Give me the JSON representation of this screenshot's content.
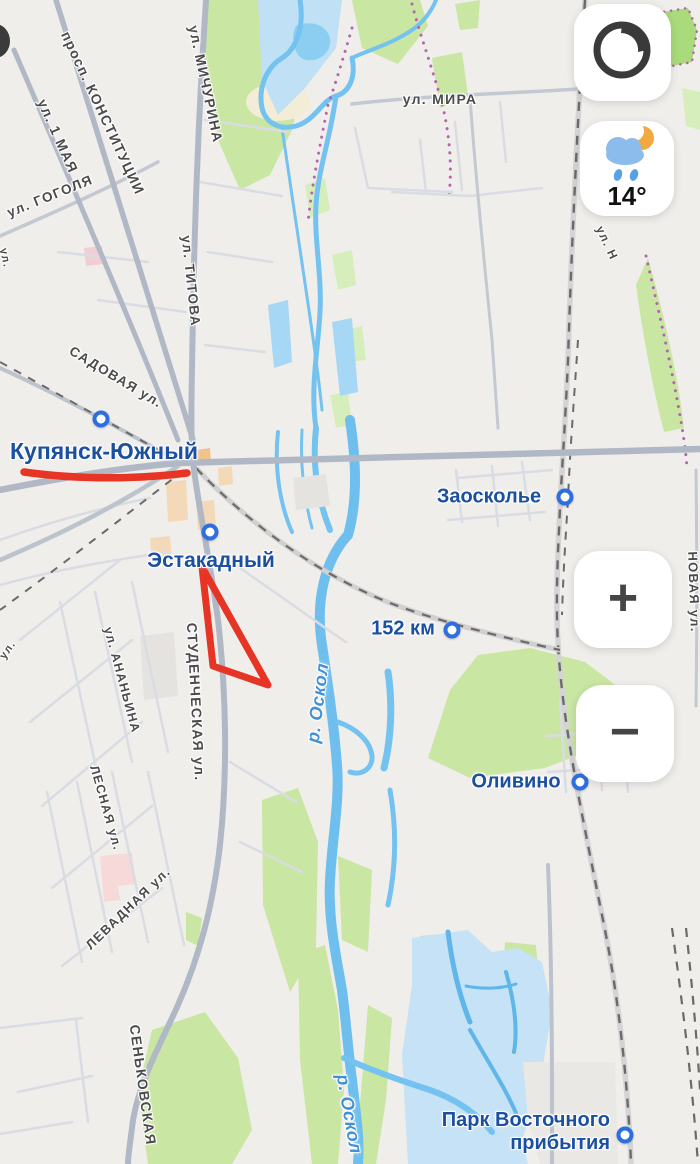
{
  "controls": {
    "layers_button": {
      "icon": "layers-globe-icon"
    },
    "weather": {
      "temperature": "14°",
      "icon": "moon-rain-cloud-icon"
    },
    "zoom_in_label": "+",
    "zoom_out_label": "−"
  },
  "annotations": {
    "color": "#e63425",
    "shapes": [
      "underline-stroke",
      "triangle-outline"
    ]
  },
  "map": {
    "places": [
      {
        "label": "Купянск-Южный",
        "x": 104,
        "y": 451,
        "size": 23,
        "marker_x": 101,
        "marker_y": 419
      },
      {
        "label": "Эстакадный",
        "x": 211,
        "y": 561,
        "size": 21,
        "marker_x": 210,
        "marker_y": 532
      },
      {
        "label": "Заосколье",
        "x": 489,
        "y": 497,
        "size": 20,
        "marker_x": 565,
        "marker_y": 497
      },
      {
        "label": "152 км",
        "x": 403,
        "y": 629,
        "size": 20,
        "marker_x": 452,
        "marker_y": 630
      },
      {
        "label": "Оливино",
        "x": 516,
        "y": 782,
        "size": 20,
        "marker_x": 580,
        "marker_y": 782
      },
      {
        "label": "Парк Восточного прибытия",
        "lines": [
          "Парк Восточного",
          "прибытия"
        ],
        "x": 610,
        "y": 1132,
        "size": 20,
        "marker_x": 625,
        "marker_y": 1135
      }
    ],
    "streets": [
      {
        "label": "просп. КОНСТИТУЦИИ",
        "x": 103,
        "y": 113,
        "rotate": 65,
        "size": 14
      },
      {
        "label": "ул. 1 МАЯ",
        "x": 58,
        "y": 136,
        "rotate": 66,
        "size": 14
      },
      {
        "label": "ул. ГОГОЛЯ",
        "x": 50,
        "y": 196,
        "rotate": -22,
        "size": 13.5
      },
      {
        "label": "ул. МИЧУРИНА",
        "x": 206,
        "y": 84,
        "rotate": 78,
        "size": 14
      },
      {
        "label": "ул. ТИТОВА",
        "x": 191,
        "y": 281,
        "rotate": 84,
        "size": 13.5
      },
      {
        "label": "ул. МИРА",
        "x": 440,
        "y": 99,
        "rotate": 0,
        "size": 14
      },
      {
        "label": "САДОВАЯ ул.",
        "x": 116,
        "y": 377,
        "rotate": 31,
        "size": 13.5
      },
      {
        "label": "СТУДЕНЧЕСКАЯ ул.",
        "x": 196,
        "y": 702,
        "rotate": 87,
        "size": 14
      },
      {
        "label": "ул. АНАНЬИНА",
        "x": 122,
        "y": 680,
        "rotate": 75,
        "size": 12.5
      },
      {
        "label": "ЛЕСНАЯ ул.",
        "x": 106,
        "y": 808,
        "rotate": 74,
        "size": 12.5
      },
      {
        "label": "ЛЕВАДНАЯ ул.",
        "x": 128,
        "y": 908,
        "rotate": -44,
        "size": 13
      },
      {
        "label": "СЕНЬКОВСКАЯ",
        "x": 143,
        "y": 1085,
        "rotate": 82,
        "size": 14
      },
      {
        "label": "НОВАЯ ул.",
        "x": 694,
        "y": 592,
        "rotate": 88,
        "size": 13
      },
      {
        "label": "ул. Н",
        "x": 607,
        "y": 243,
        "rotate": 65,
        "size": 12
      },
      {
        "label": "ул.",
        "x": 8,
        "y": 650,
        "rotate": -55,
        "size": 11
      },
      {
        "label": "ул.",
        "x": 5,
        "y": 258,
        "rotate": 78,
        "size": 11
      }
    ],
    "water_labels": [
      {
        "label": "р. Оскол",
        "x": 318,
        "y": 703,
        "rotate": -83
      },
      {
        "label": "р. Оскол",
        "x": 349,
        "y": 1114,
        "rotate": 80
      }
    ]
  }
}
